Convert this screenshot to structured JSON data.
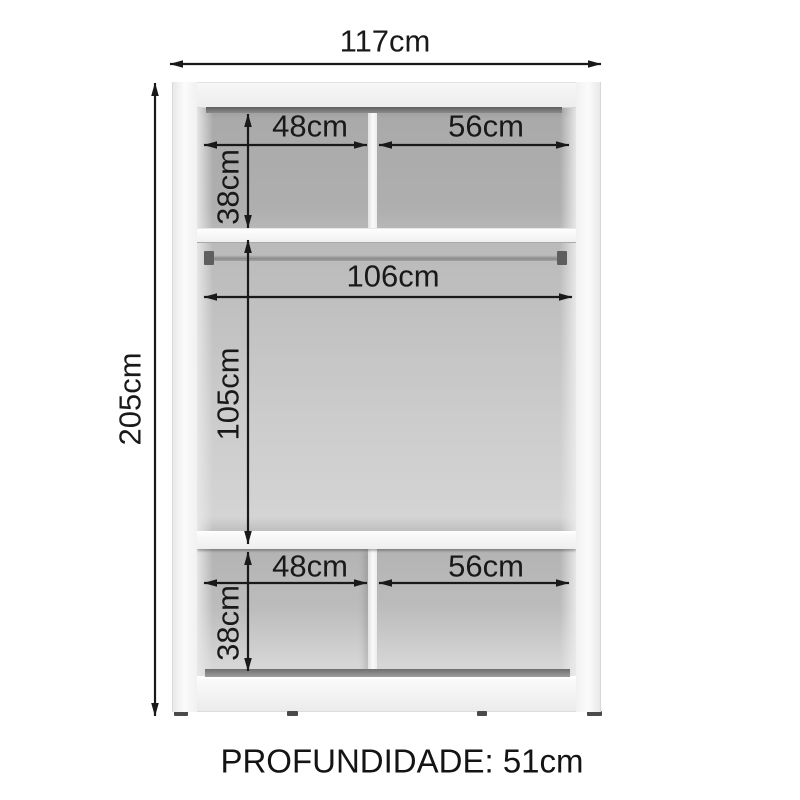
{
  "diagram": {
    "overall": {
      "width_label": "117cm",
      "height_label": "205cm"
    },
    "top_section": {
      "left_width_label": "48cm",
      "right_width_label": "56cm",
      "height_label": "38cm"
    },
    "middle_section": {
      "width_label": "106cm",
      "height_label": "105cm"
    },
    "bottom_section": {
      "left_width_label": "48cm",
      "right_width_label": "56cm",
      "height_label": "38cm"
    },
    "depth_label": "PROFUNDIDADE: 51cm",
    "colors": {
      "dimension_ink": "#191919",
      "interior_gray": "#bdbdbd",
      "cabinet_white": "#f5f5f5",
      "dark_strip": "#6f6f6f"
    }
  }
}
